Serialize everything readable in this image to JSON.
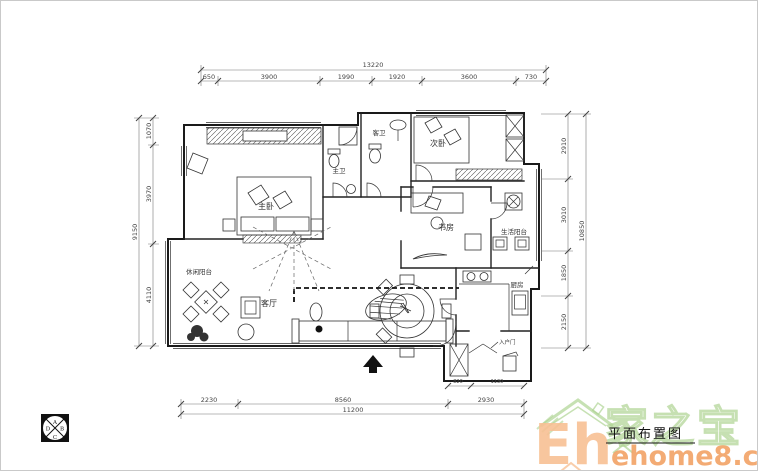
{
  "title_block": {
    "title": "平面布置图"
  },
  "rooms": {
    "master_bedroom": "主卧",
    "master_bath": "主卫",
    "guest_bath": "客卫",
    "second_bedroom": "次卧",
    "study": "书房",
    "service_balcony": "生活阳台",
    "kitchen": "厨房",
    "living_room": "客厅",
    "leisure_balcony": "休闲阳台",
    "entry_door": "入户门"
  },
  "dimensions": {
    "top": {
      "total": "13220",
      "segments": [
        "650",
        "3900",
        "1990",
        "1920",
        "3600",
        "730"
      ]
    },
    "left": {
      "total": "9150",
      "segments": [
        "1070",
        "3970",
        "4110"
      ]
    },
    "right": {
      "total": "10850",
      "segments": [
        "2910",
        "3010",
        "1850",
        "2150"
      ]
    },
    "bottom": {
      "total": "11200",
      "segments": [
        "2230",
        "8560",
        "2930"
      ]
    },
    "entry": {
      "segments": [
        "820",
        "1130"
      ]
    }
  },
  "compass": {
    "top": "A",
    "right": "B",
    "bottom": "C",
    "left": "D"
  },
  "watermark": {
    "brand_cn": "家之宝",
    "brand_initials": "Eh",
    "domain": "ehome8.com",
    "green": "#93c46d",
    "orange_light": "#f5ab70",
    "orange_deep": "#ee8432"
  },
  "colors": {
    "paper": "#ffffff",
    "line": "#1a1a1a",
    "dim_line": "#777777"
  }
}
